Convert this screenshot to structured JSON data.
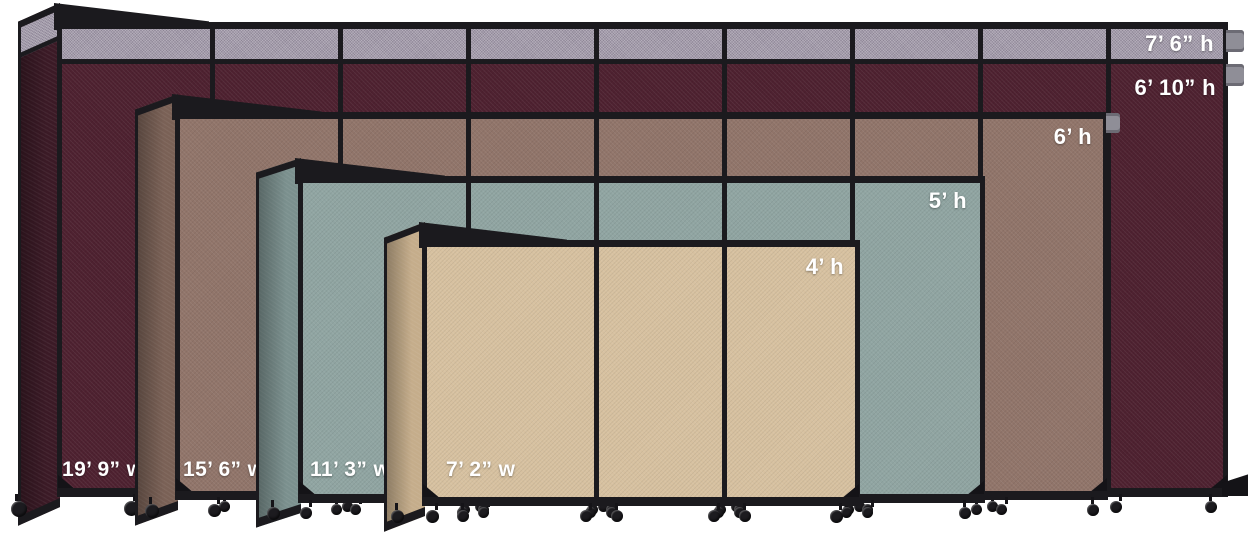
{
  "description": "Size comparison of rolling room divider partitions shown nested front to back",
  "colors": {
    "frame": "#1b1a1e",
    "background": "#ffffff",
    "label_text": "#ffffff"
  },
  "partitions": [
    {
      "name": "19ft9-burgundy",
      "width_label": "19’ 9” w",
      "height_label": "7’ 6” h",
      "secondary_height_label": "6’ 10” h",
      "fabric_color": "#4e2130",
      "return_color": "#3b1a26",
      "top_extender_color": "#a39bab"
    },
    {
      "name": "15ft6-brown",
      "width_label": "15’ 6” w",
      "height_label": "6’ h",
      "fabric_color": "#91756a",
      "return_color": "#7a6156"
    },
    {
      "name": "11ft3-slate",
      "width_label": "11’ 3” w",
      "height_label": "5’ h",
      "fabric_color": "#90a5a2",
      "return_color": "#7b908e"
    },
    {
      "name": "7ft2-sand",
      "width_label": "7’ 2” w",
      "height_label": "4’ h",
      "fabric_color": "#d7c1a0",
      "return_color": "#c5ad8b"
    }
  ]
}
